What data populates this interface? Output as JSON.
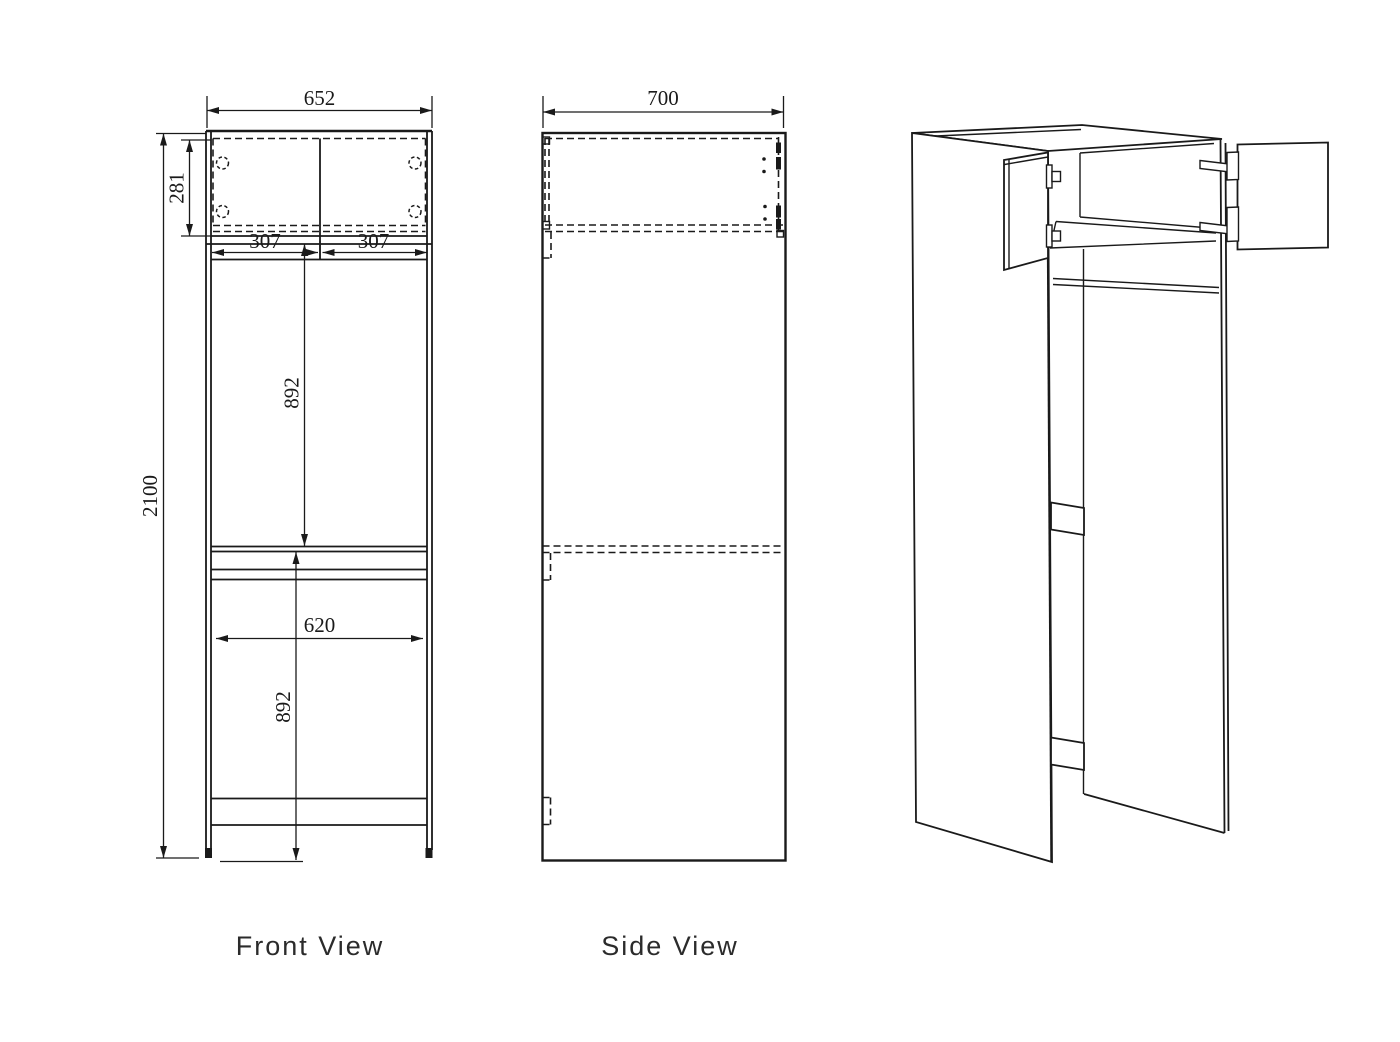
{
  "drawing": {
    "front_view": {
      "label": "Front View",
      "dims": {
        "width": "652",
        "upper_box_height": "281",
        "door_left": "307",
        "door_right": "307",
        "upper_opening": "892",
        "total_height": "2100",
        "lower_width": "620",
        "lower_opening": "892"
      }
    },
    "side_view": {
      "label": "Side View",
      "dims": {
        "depth": "700"
      }
    },
    "isometric_view": {},
    "colors": {
      "line": "#1a1a1a",
      "background": "#ffffff"
    }
  }
}
